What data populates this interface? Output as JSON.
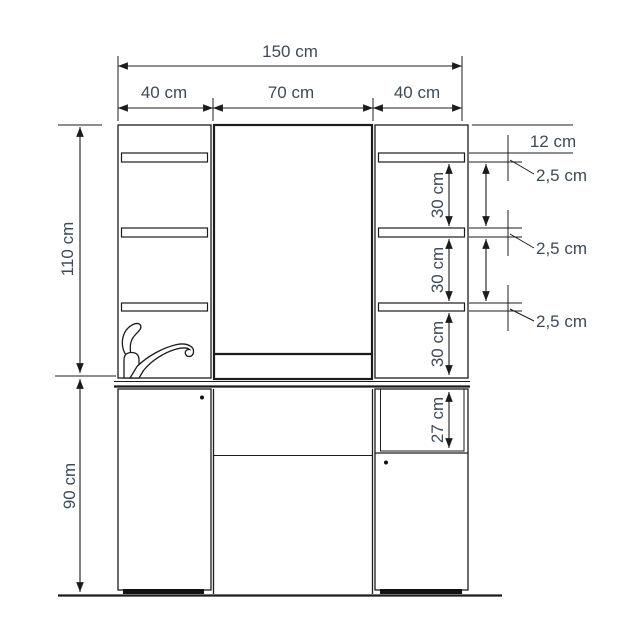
{
  "drawing": {
    "type": "furniture-front-elevation-dimension-drawing",
    "colors": {
      "background": "#ffffff",
      "line": "#1c1c1c",
      "dimension_label": "#3d4a57"
    },
    "dimensions": {
      "total_width": "150 cm",
      "left_section_width": "40 cm",
      "center_section_width": "70 cm",
      "right_section_width": "40 cm",
      "upper_section_height": "110 cm",
      "lower_section_height": "90 cm",
      "top_to_first_shelf": "12 cm",
      "shelf_thickness_top": "2,5 cm",
      "shelf_thickness_middle": "2,5 cm",
      "shelf_thickness_bottom": "2,5 cm",
      "shelf_gap_top": "30 cm",
      "shelf_gap_middle": "30 cm",
      "shelf_gap_bottom": "30 cm",
      "open_compartment_height": "27 cm"
    }
  }
}
